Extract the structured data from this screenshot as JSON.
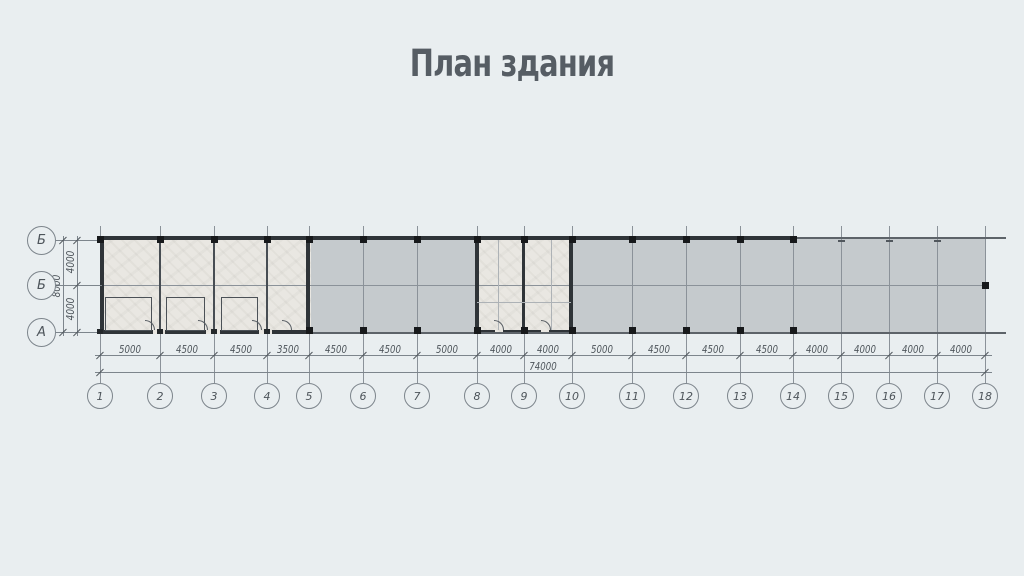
{
  "title": "План здания",
  "plan": {
    "row_axes": [
      "Б",
      "Б",
      "А"
    ],
    "column_axes": [
      "1",
      "2",
      "3",
      "4",
      "5",
      "6",
      "7",
      "8",
      "9",
      "10",
      "11",
      "12",
      "13",
      "14",
      "15",
      "16",
      "17",
      "18"
    ],
    "dimensions": {
      "horizontal_segments": [
        "5000",
        "4500",
        "4500",
        "3500",
        "4500",
        "4500",
        "5000",
        "4000",
        "4000",
        "5000",
        "4500",
        "4500",
        "4500",
        "4000",
        "4000",
        "4000",
        "4000"
      ],
      "horizontal_total": "74000",
      "vertical_segments": [
        "4000",
        "4000"
      ],
      "vertical_total": "8000"
    }
  },
  "colors": {
    "background": "#e9eef0",
    "slab_fill": "#c5cacd",
    "room_fill": "#e9e7e2",
    "wall": "#2f3438",
    "grid_line": "#8b9299",
    "dimension_line": "#7d858c",
    "text": "#4d545a",
    "title": "#565d64"
  }
}
